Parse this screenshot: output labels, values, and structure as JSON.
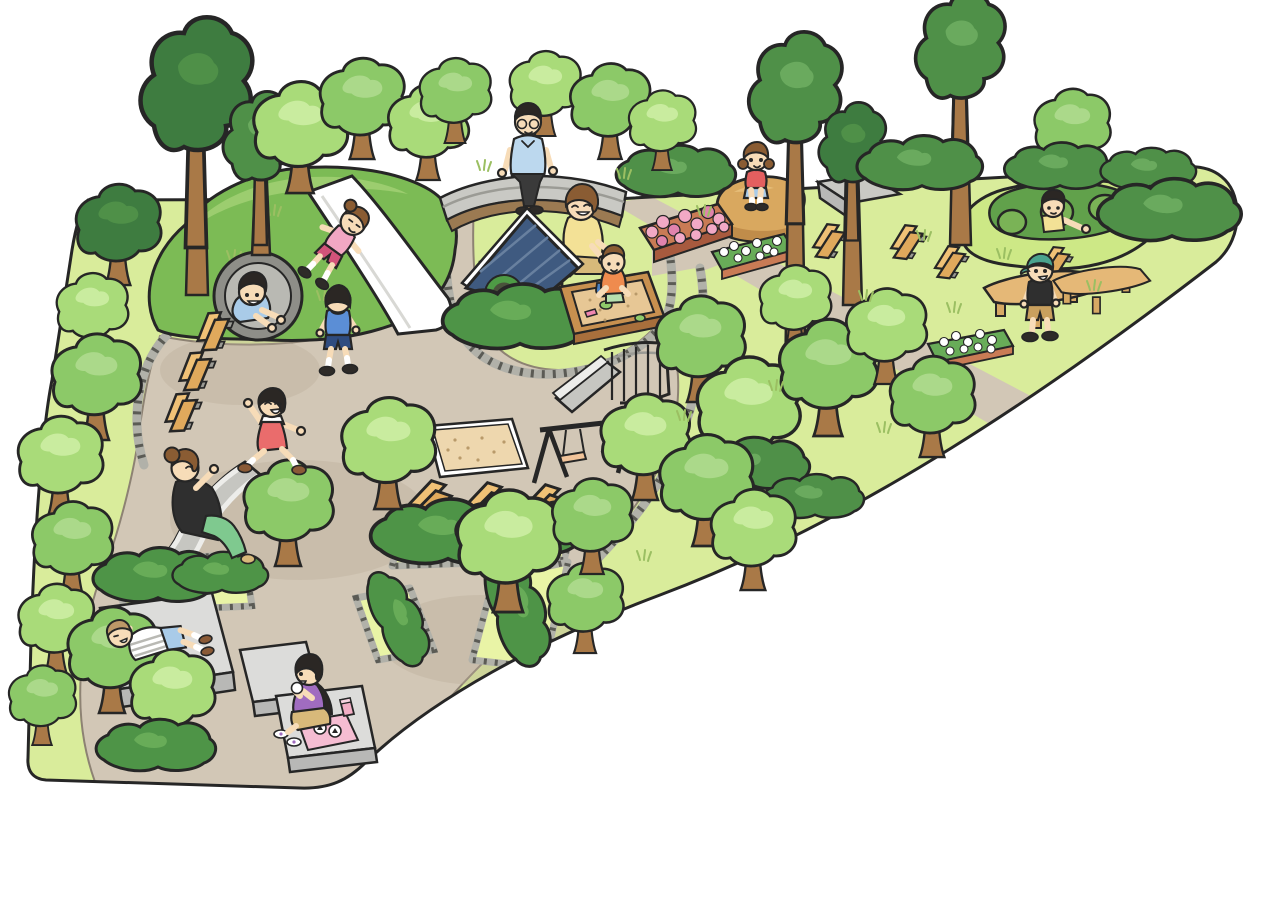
{
  "scene": {
    "description": "Cartoon overhead illustration of a children's park: grassy wedge-shaped grounds with winding tan paths, many round trees, two play hills with tunnels, a playhouse with sandbox, swings, slides, benches, picnic tables, flower beds and thirteen people",
    "style": "flat cartoon with black outlines",
    "background": "white"
  },
  "palette": {
    "outline": "#262626",
    "grass": "#d9ec9b",
    "bed_grass": "#e9f4a6",
    "tuft": "#9bbf62",
    "path": "#d2c7b6",
    "path_line": "#8d8273",
    "path_shadow": "#b9ab97",
    "cobble": "#b1b1a9",
    "cobble_dark": "#5b5b55",
    "hill": "#7cbb55",
    "hill_light": "#9ccd6f",
    "dome": "#cde886",
    "dome_dark": "#61a14b",
    "dome_hole": "#7ab356",
    "tree_light": "#a9db79",
    "tree_light_hi": "#c9ec9f",
    "tree_mid": "#8cc968",
    "tree_mid_hi": "#abd98a",
    "tree_dark": "#4f9048",
    "tree_dark_hi": "#6aaa5e",
    "tree_deep": "#3e7c40",
    "hedge": "#4e9447",
    "hedge_hi": "#68ac58",
    "trunk": "#a97947",
    "stone": "#c9c9c4",
    "stone_dark": "#9b9b95",
    "stone_base": "#9b7a52",
    "platform": "#dcdcda",
    "platform_side": "#b8b8b6",
    "bench": "#f0c176",
    "bench_seat": "#e0a95c",
    "bench_foot": "#9a9a94",
    "table": "#e5b877",
    "table_leg": "#d7a964",
    "wood": "#c8904f",
    "wood_dark": "#a86f3c",
    "wood_gable": "#b07b42",
    "roof": "#3f5a80",
    "roof_line": "#68809f",
    "window_ring": "#4e9b45",
    "window_glass": "#49523b",
    "sand": "#e7c795",
    "sandpit": "#eed7ae",
    "rock": "#d9a85f",
    "rock_dark": "#c08c4a",
    "rock_hi": "#e6bd78",
    "flower_pink": "#f2a9c6",
    "flower_pink_dark": "#e083ad",
    "planter": "#c97b55",
    "planter_dark": "#a85a3e",
    "white": "#ffffff",
    "slide_gray": "#c6c6c1",
    "slide_light": "#ededea",
    "tunnel_ring": "#8e8e88",
    "tunnel_in": "#b9b9b3",
    "skin": "#f7dcb8",
    "hair_dark": "#2b2724",
    "hair_brown": "#8a5c33",
    "hair_light": "#bd9868",
    "shirt_pink": "#f2a7c3",
    "shorts_pink": "#d2537a",
    "shirt_blue": "#5b8ed6",
    "shorts_navy": "#2f4c80",
    "shirt_ltblue": "#bcd8ee",
    "shirt_yellow": "#f3e196",
    "shirt_orange": "#ef8b4e",
    "shirt_red": "#e35f5f",
    "dress_red": "#ea6c6c",
    "shorts_ltblue": "#a9cbe8",
    "shorts_mint": "#b7dfae",
    "cap_teal": "#4aa38e",
    "shirt_black": "#2f2f2f",
    "shorts_khaki": "#c9a05e",
    "pants_green": "#7fc98f",
    "shirt_purple": "#a06cc0",
    "skirt_tan": "#d8b97a",
    "blanket": "#f5bdd2",
    "thermos": "#f3aec5",
    "swing_seat": "#f2c49a",
    "sock": "#ffffff",
    "shoe_dark": "#2e2b28",
    "shoe_brown": "#8a5a36",
    "bucket_blue": "#4a7fc0",
    "toy_green": "#8fca6a",
    "toy_pink": "#ef86b0"
  },
  "people": [
    {
      "id": "girl-on-hill-slide",
      "appearance": "girl with brown ponytail, pink shirt, dark pink shorts, sliding down white hill slide"
    },
    {
      "id": "boy-in-tunnel",
      "appearance": "boy with dark brown hair and light blue shirt crawling out of hill tunnel"
    },
    {
      "id": "boy-walking",
      "appearance": "boy with black hair, blue hooded shirt, navy shorts walking on the path"
    },
    {
      "id": "man-on-stone-bench",
      "appearance": "man with glasses, light blue shirt, dark trousers sitting on curved stone bench"
    },
    {
      "id": "mother-at-sandbox",
      "appearance": "woman with brown bob, yellow top, khaki skirt kneeling at the sandbox"
    },
    {
      "id": "toddler-in-sandbox",
      "appearance": "toddler in orange shirt playing with a blue bucket in the sandbox"
    },
    {
      "id": "girl-on-rock",
      "appearance": "girl with brown pigtails, red shirt, light blue shorts squatting on a rock mound"
    },
    {
      "id": "kid-in-dome-hole",
      "appearance": "child with black hair and yellow shirt peeking from a hole in the green dome"
    },
    {
      "id": "boy-with-cap",
      "appearance": "boy with teal cap, black t-shirt, khaki shorts standing between picnic tables"
    },
    {
      "id": "girl-running",
      "appearance": "girl with black bob, red dress over white tee, running with arms out"
    },
    {
      "id": "woman-on-wide-slide",
      "appearance": "woman with brown bun, black top, green pants sitting on the wide gray slide"
    },
    {
      "id": "boy-lying-on-platform",
      "appearance": "boy in striped shirt and blue shorts lying on a stone platform with hands behind head"
    },
    {
      "id": "girl-picnicking",
      "appearance": "girl with long black hair, purple shirt, tan skirt eating rice balls on a pink blanket"
    }
  ],
  "playground_equipment": [
    "grass hill with tunnel and white slide",
    "green dome hill with three crawl holes",
    "wide gray free slide",
    "metal slide with stair railing",
    "two-seat swing set",
    "square sand pit",
    "wooden playhouse with blue shingle roof and round green window",
    "wooden sandbox with toys",
    "curved stone sitting wall"
  ],
  "furniture": {
    "benches": 10,
    "picnic_tables": 2,
    "stone_platforms": 3
  },
  "landscaping": {
    "flower_beds": [
      {
        "type": "pink flowers in terracotta planter"
      },
      {
        "type": "white flowers in terracotta planter near rock"
      },
      {
        "type": "white flowers in planter near dome hill"
      }
    ],
    "hedge_beds": 5,
    "round_trees": "about 30",
    "tall_trees": 6,
    "rock_mound": 1,
    "stone_wedge_sculpture": 1
  },
  "picnic_items": {
    "blanket": "pink cloth",
    "rice_balls": 3,
    "thermos": "pink bottle"
  }
}
